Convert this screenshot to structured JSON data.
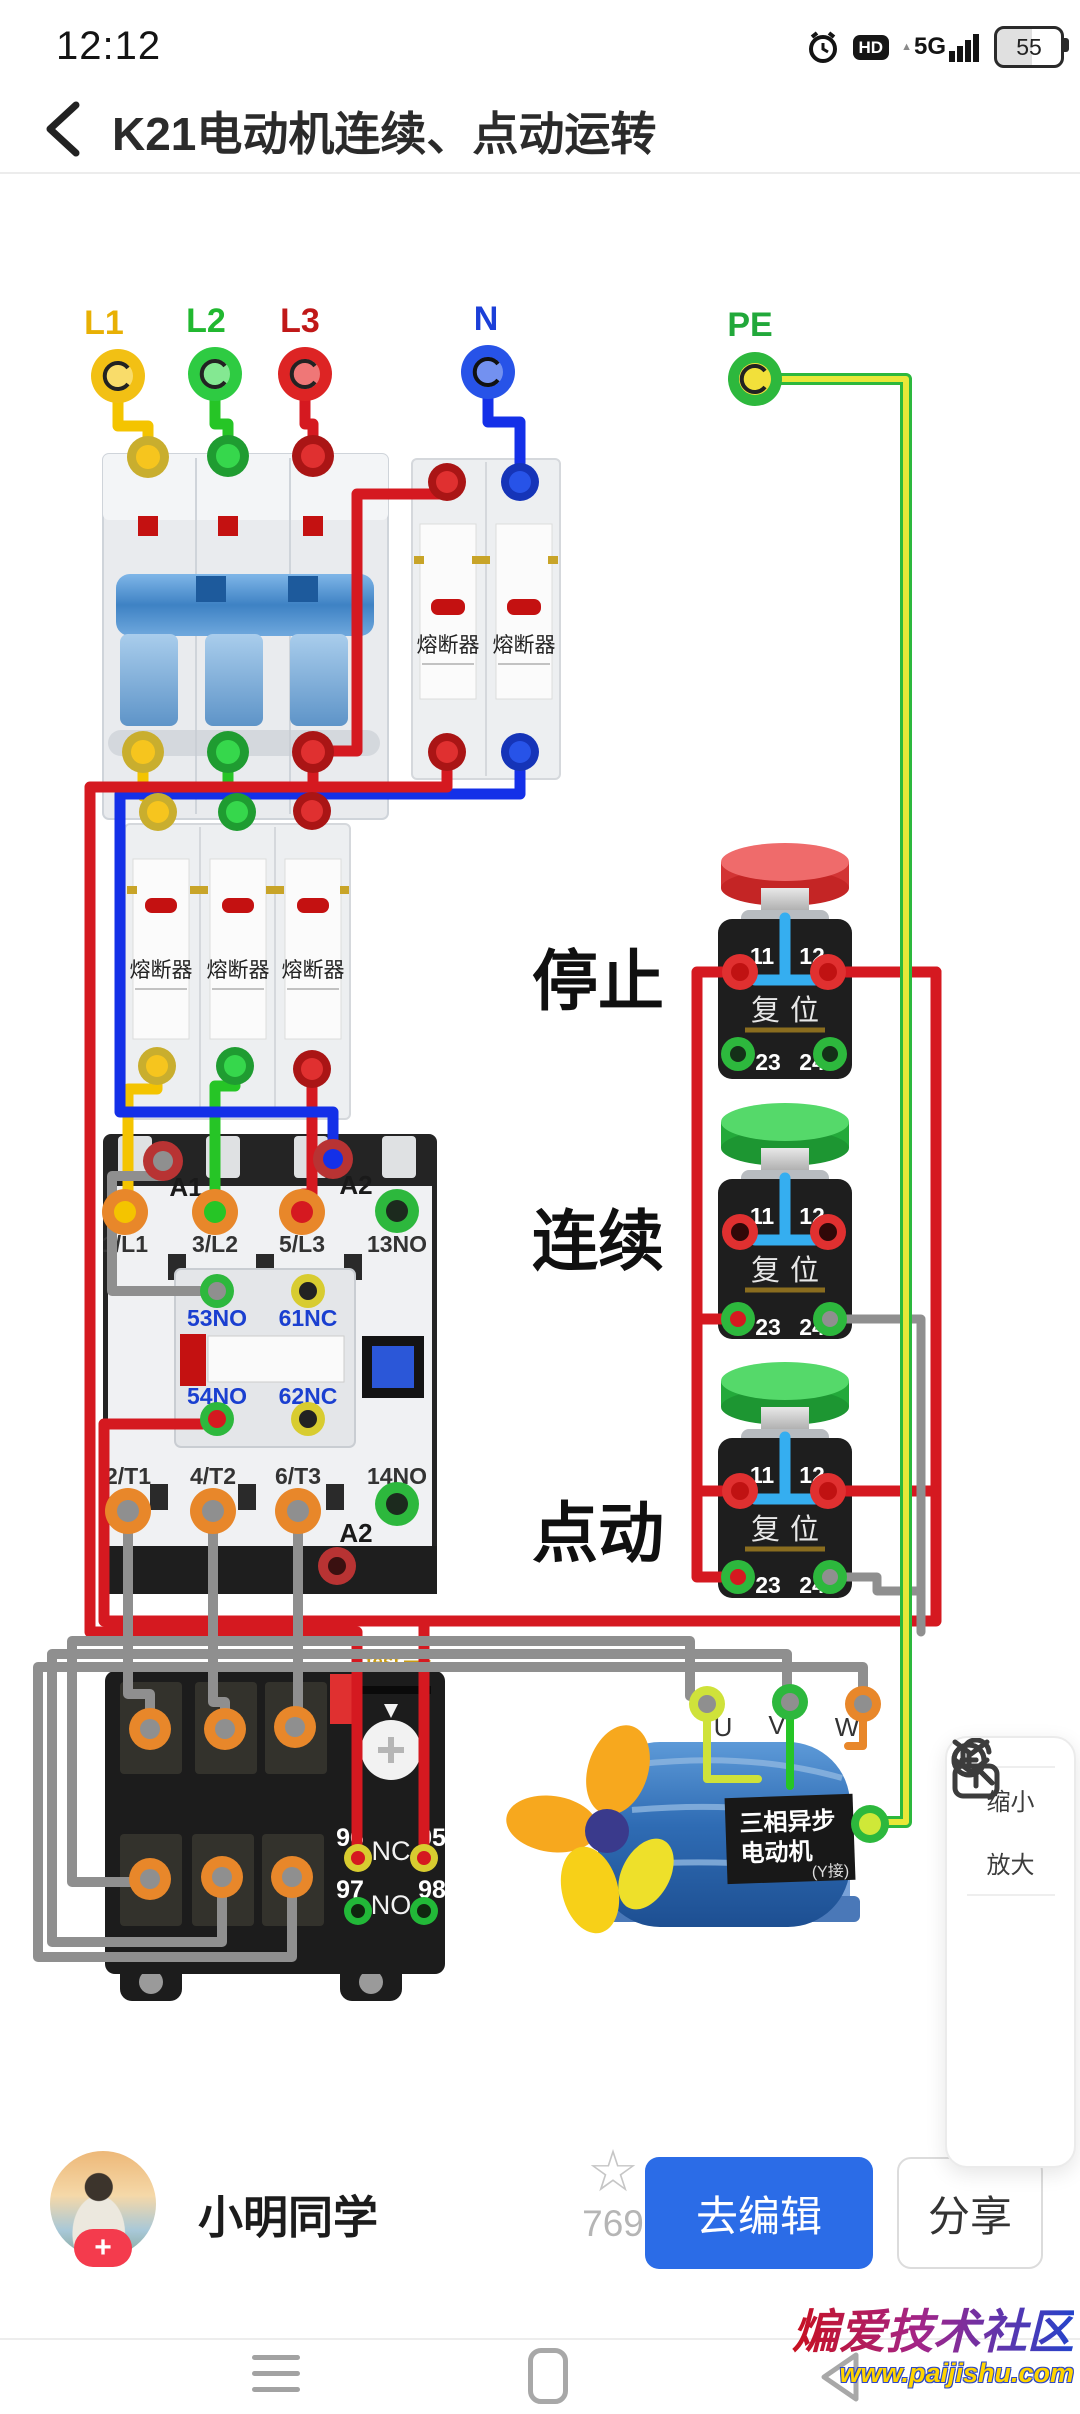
{
  "status_bar": {
    "time": "12:12",
    "hd": "HD",
    "network": "5G",
    "battery": "55"
  },
  "header": {
    "title": "K21电动机连续、点动运转"
  },
  "diagram": {
    "source_terminals": {
      "l1": "L1",
      "l2": "L2",
      "l3": "L3",
      "n": "N",
      "pe": "PE"
    },
    "fuse_label": "熔断器",
    "contactor": {
      "a1": "A1",
      "a2_top": "A2",
      "l1": "1/L1",
      "l2": "3/L2",
      "l3": "5/L3",
      "no13": "13NO",
      "no53": "53NO",
      "nc61": "61NC",
      "no54": "54NO",
      "nc62": "62NC",
      "t1": "2/T1",
      "t2": "4/T2",
      "t3": "6/T3",
      "no14": "14NO",
      "a2_bottom": "A2"
    },
    "buttons": {
      "stop": "停止",
      "run": "连续",
      "jog": "点动",
      "t11": "11",
      "t12": "12",
      "t23": "23",
      "t24": "24",
      "reset": "复位"
    },
    "thermal": {
      "test": "test",
      "n96": "96",
      "n95": "95",
      "n97": "97",
      "n98": "98",
      "nc": "NC",
      "no": "NO"
    },
    "motor": {
      "u": "U",
      "v": "V",
      "w": "W",
      "line1": "三相异步",
      "line2": "电动机",
      "line3": "(Y接)"
    }
  },
  "side_panel": {
    "zoom_out": "缩小",
    "zoom_in": "放大"
  },
  "user_bar": {
    "username": "小明同学",
    "star_count": "769",
    "edit": "去编辑",
    "share": "分享"
  },
  "watermark": {
    "line1": "煸爱技术社区",
    "line2": "www.paijishu.com"
  },
  "colors": {
    "accent": "#2b6ce7",
    "wire_red": "#d51920",
    "wire_blue": "#1430e8",
    "wire_yellow": "#f4c400",
    "wire_green": "#26c526",
    "wire_gray": "#8f8f8f",
    "wire_pe": "#dde23a"
  }
}
